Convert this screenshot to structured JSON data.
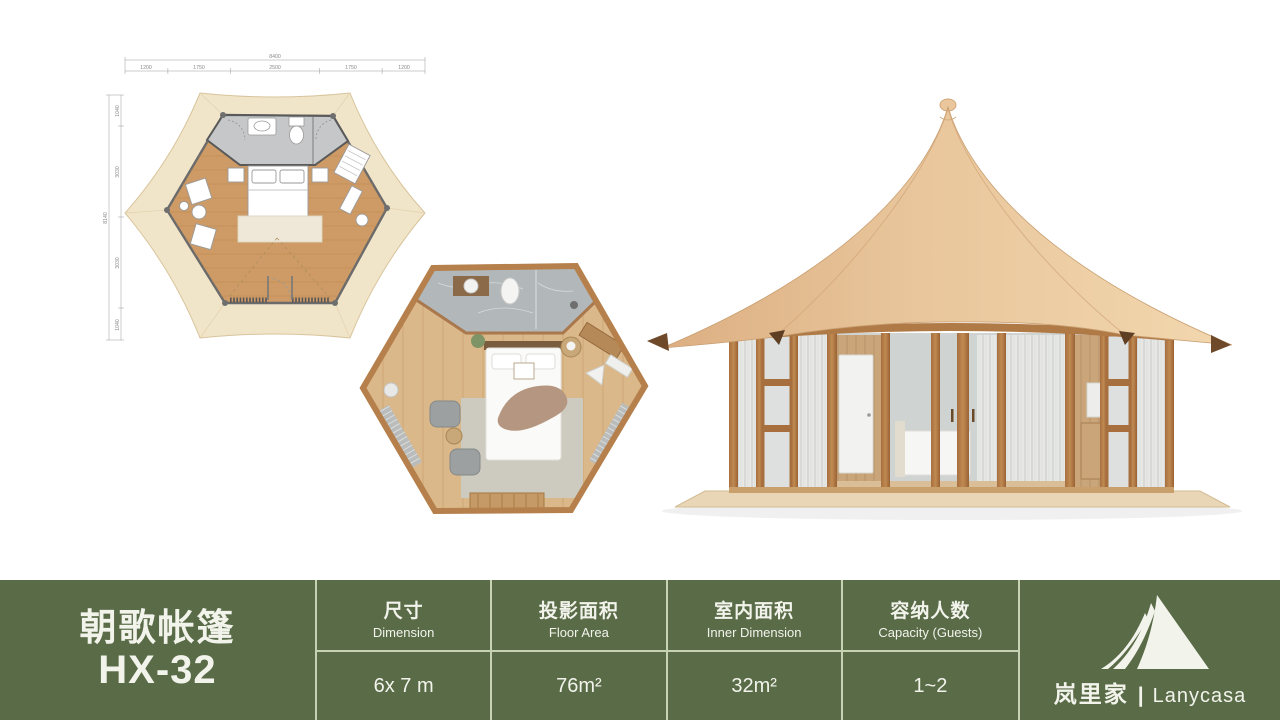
{
  "page": {
    "background": "#ffffff",
    "bar_color": "#5A6B48",
    "grid_line_color": "#C7D1B4",
    "roof_color": "#E9C69C",
    "canopy_color": "#F1E5C9"
  },
  "spec_bar": {
    "model_name": "朝歌帐篷",
    "model_code": "HX-32",
    "columns": [
      {
        "zh": "尺寸",
        "en": "Dimension",
        "value": "6x 7 m"
      },
      {
        "zh": "投影面积",
        "en": "Floor Area",
        "value": "76m²"
      },
      {
        "zh": "室内面积",
        "en": "Inner Dimension",
        "value": "32m²"
      },
      {
        "zh": "容纳人数",
        "en": "Capacity (Guests)",
        "value": "1~2"
      }
    ],
    "brand": {
      "zh": "岚里家",
      "divider": "|",
      "en": "Lanycasa"
    }
  },
  "floor_plan": {
    "dims_top": {
      "total": "8400",
      "segments": [
        "1200",
        "1750",
        "2500",
        "1750",
        "1200"
      ]
    },
    "dims_left": {
      "total": "8140",
      "segments": [
        "1040",
        "3030",
        "3030",
        "1040"
      ]
    }
  },
  "icons": {
    "logo": "lanycasa-tent-logo",
    "plan_schematic": "hexagon-floor-plan-schematic",
    "plan_render": "hexagon-floor-plan-3d-top-view",
    "tent_render": "tent-exterior-3d-render"
  }
}
